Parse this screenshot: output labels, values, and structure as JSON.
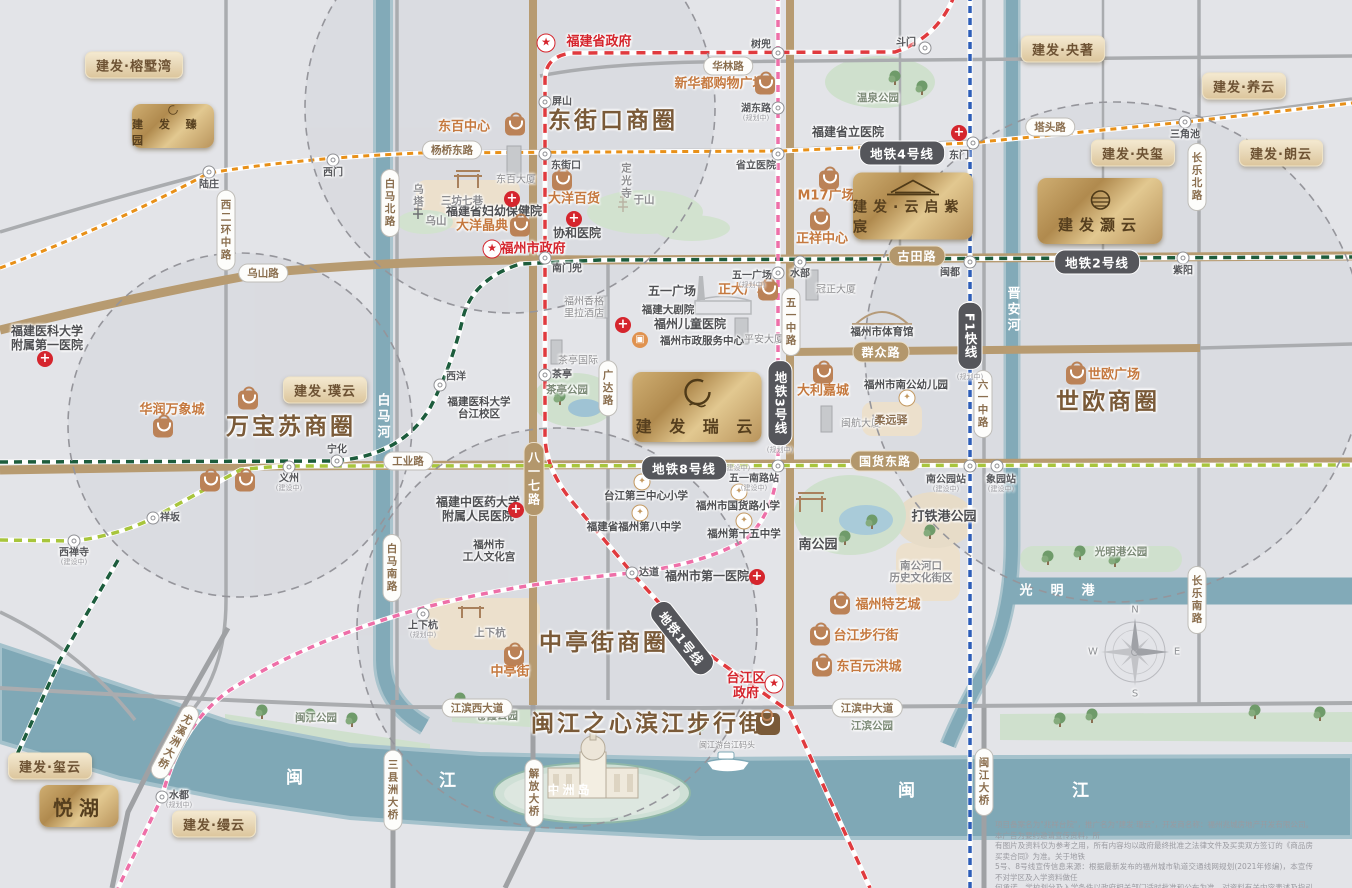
{
  "brand_map_title": "建发瑞云",
  "colors": {
    "gold": "#c2a briefly06e",
    "accent_gold": "#c9a96a",
    "district_brown": "#7a5a38",
    "metro_line1": "#e03a3e",
    "metro_line2": "#1c5c3c",
    "metro_line3": "#ee6fa8",
    "metro_line4": "#e89018",
    "metro_line8": "#a8c53c",
    "metro_f1": "#2e5eb8",
    "road_major": "#b79b71",
    "river": "#7fa8b6",
    "shop_orange": "#c5793f",
    "red": "#d5252d"
  },
  "districts": [
    {
      "name": "东街口商圈",
      "x": 613,
      "y": 121
    },
    {
      "name": "万宝苏商圈",
      "x": 291,
      "y": 427
    },
    {
      "name": "世欧商圈",
      "x": 1108,
      "y": 402
    },
    {
      "name": "中亭街商圈",
      "x": 604,
      "y": 643
    },
    {
      "name": "闽江之心滨江步行街",
      "x": 648,
      "y": 724,
      "bagX": 768,
      "bagY": 724
    }
  ],
  "metro": {
    "lines": [
      {
        "id": "ml1",
        "name": "地铁1号线",
        "color": "#e03a3e"
      },
      {
        "id": "ml2",
        "name": "地铁2号线",
        "color": "#1c5c3c"
      },
      {
        "id": "ml2b",
        "name": "地铁2号线",
        "color": "#1c5c3c"
      },
      {
        "id": "ml3",
        "name": "地铁3号线",
        "color": "#ee6fa8"
      },
      {
        "id": "ml4",
        "name": "地铁4号线",
        "color": "#e89018"
      },
      {
        "id": "ml8",
        "name": "地铁8号线",
        "color": "#a8c53c"
      },
      {
        "id": "mlf1",
        "name": "F1快线",
        "color": "#2e5eb8"
      }
    ],
    "badges": [
      {
        "text": "地铁4号线",
        "x": 902,
        "y": 153,
        "orient": "h"
      },
      {
        "text": "地铁2号线",
        "x": 1097,
        "y": 262,
        "orient": "h"
      },
      {
        "text": "地铁8号线",
        "x": 684,
        "y": 468,
        "orient": "h",
        "tag": "(建设中)",
        "tx": 737,
        "ty": 468
      },
      {
        "text": "地铁3号线",
        "x": 780,
        "y": 403,
        "orient": "v",
        "tag": "(规划中)",
        "tx": 780,
        "ty": 450
      },
      {
        "text": "F1快线",
        "x": 970,
        "y": 336,
        "orient": "v",
        "tag": "(规划中)",
        "tx": 970,
        "ty": 377
      },
      {
        "text": "地铁1号线",
        "x": 682,
        "y": 638,
        "orient": "h",
        "rotate": 52
      }
    ],
    "stations": [
      {
        "n": "陆庄",
        "x": 209,
        "y": 172,
        "lx": 209,
        "ly": 185
      },
      {
        "n": "西门",
        "x": 333,
        "y": 160,
        "lx": 333,
        "ly": 173
      },
      {
        "n": "东街口",
        "x": 545,
        "y": 154,
        "lx": 566,
        "ly": 166
      },
      {
        "n": "省立医院",
        "x": 778,
        "y": 154,
        "lx": 756,
        "ly": 166
      },
      {
        "n": "东门",
        "x": 973,
        "y": 143,
        "lx": 959,
        "ly": 156
      },
      {
        "n": "三角池",
        "x": 1185,
        "y": 122,
        "lx": 1185,
        "ly": 135
      },
      {
        "n": "斗门",
        "x": 925,
        "y": 48,
        "lx": 906,
        "ly": 43
      },
      {
        "n": "树兜",
        "x": 778,
        "y": 53,
        "lx": 761,
        "ly": 45
      },
      {
        "n": "屏山",
        "x": 545,
        "y": 102,
        "lx": 562,
        "ly": 102
      },
      {
        "n": "湖东路",
        "x": 778,
        "y": 108,
        "lx": 756,
        "ly": 109,
        "tag": "(规划中)",
        "tx": 756,
        "ty": 118
      },
      {
        "n": "南门兜",
        "x": 545,
        "y": 258,
        "lx": 567,
        "ly": 269
      },
      {
        "n": "水部",
        "x": 800,
        "y": 262,
        "lx": 800,
        "ly": 274
      },
      {
        "n": "闽都",
        "x": 970,
        "y": 262,
        "lx": 950,
        "ly": 273
      },
      {
        "n": "紫阳",
        "x": 1183,
        "y": 258,
        "lx": 1183,
        "ly": 271
      },
      {
        "n": "五一广场",
        "x": 778,
        "y": 273,
        "lx": 752,
        "ly": 276,
        "tag": "(规划中)",
        "tx": 752,
        "ty": 285
      },
      {
        "n": "茶亭",
        "x": 545,
        "y": 375,
        "lx": 562,
        "ly": 375
      },
      {
        "n": "西洋",
        "x": 440,
        "y": 385,
        "lx": 456,
        "ly": 377
      },
      {
        "n": "宁化",
        "x": 337,
        "y": 461,
        "lx": 337,
        "ly": 450
      },
      {
        "n": "义州",
        "x": 289,
        "y": 467,
        "lx": 289,
        "ly": 479,
        "tag": "(建设中)",
        "tx": 289,
        "ty": 488
      },
      {
        "n": "祥坂",
        "x": 153,
        "y": 518,
        "lx": 170,
        "ly": 518
      },
      {
        "n": "西禅寺",
        "x": 74,
        "y": 541,
        "lx": 74,
        "ly": 553,
        "tag": "(建设中)",
        "tx": 74,
        "ty": 562
      },
      {
        "n": "达道",
        "x": 632,
        "y": 573,
        "lx": 649,
        "ly": 573
      },
      {
        "n": "五一南路站",
        "x": 778,
        "y": 466,
        "lx": 754,
        "ly": 479,
        "tag": "(建设中)",
        "tx": 754,
        "ty": 488
      },
      {
        "n": "南公园站",
        "x": 970,
        "y": 466,
        "lx": 946,
        "ly": 480,
        "tag": "(建设中)",
        "tx": 946,
        "ty": 489
      },
      {
        "n": "象园站",
        "x": 997,
        "y": 466,
        "lx": 1001,
        "ly": 480,
        "tag": "(建设中)",
        "tx": 1001,
        "ty": 489
      },
      {
        "n": "水都",
        "x": 162,
        "y": 797,
        "lx": 179,
        "ly": 796,
        "tag": "(规划中)",
        "tx": 179,
        "ty": 805
      },
      {
        "n": "上下杭",
        "x": 423,
        "y": 614,
        "lx": 423,
        "ly": 626,
        "tag": "(规划中)",
        "tx": 423,
        "ty": 635
      }
    ]
  },
  "road_labels": [
    {
      "text": "古田路",
      "x": 917,
      "y": 256,
      "style": "tan",
      "orient": "h"
    },
    {
      "text": "群众路",
      "x": 881,
      "y": 352,
      "style": "tan",
      "orient": "h"
    },
    {
      "text": "国货东路",
      "x": 885,
      "y": 461,
      "style": "tan",
      "orient": "h"
    },
    {
      "text": "八一七路",
      "x": 534,
      "y": 479,
      "style": "tan",
      "orient": "v"
    },
    {
      "text": "华林路",
      "x": 728,
      "y": 66,
      "style": "white",
      "orient": "h"
    },
    {
      "text": "杨桥东路",
      "x": 452,
      "y": 150,
      "style": "white",
      "orient": "h"
    },
    {
      "text": "塔头路",
      "x": 1050,
      "y": 127,
      "style": "white",
      "orient": "h"
    },
    {
      "text": "乌山路",
      "x": 263,
      "y": 273,
      "style": "white",
      "orient": "h"
    },
    {
      "text": "工业路",
      "x": 408,
      "y": 461,
      "style": "white",
      "orient": "h"
    },
    {
      "text": "江滨西大道",
      "x": 477,
      "y": 708,
      "style": "white",
      "orient": "h"
    },
    {
      "text": "江滨中大道",
      "x": 867,
      "y": 708,
      "style": "white",
      "orient": "h"
    },
    {
      "text": "西二环中路",
      "x": 226,
      "y": 230,
      "style": "white",
      "orient": "v"
    },
    {
      "text": "白马北路",
      "x": 390,
      "y": 203,
      "style": "white",
      "orient": "v"
    },
    {
      "text": "白马南路",
      "x": 392,
      "y": 568,
      "style": "white",
      "orient": "v"
    },
    {
      "text": "长乐北路",
      "x": 1197,
      "y": 177,
      "style": "white",
      "orient": "v"
    },
    {
      "text": "长乐南路",
      "x": 1197,
      "y": 600,
      "style": "white",
      "orient": "v"
    },
    {
      "text": "六一中路",
      "x": 983,
      "y": 404,
      "style": "white",
      "orient": "v"
    },
    {
      "text": "广达路",
      "x": 608,
      "y": 388,
      "style": "white",
      "orient": "v"
    },
    {
      "text": "五一中路",
      "x": 791,
      "y": 322,
      "style": "white",
      "orient": "v"
    },
    {
      "text": "解放大桥",
      "x": 534,
      "y": 793,
      "style": "white",
      "orient": "v"
    },
    {
      "text": "三县洲大桥",
      "x": 393,
      "y": 790,
      "style": "white",
      "orient": "v"
    },
    {
      "text": "闽江大桥",
      "x": 984,
      "y": 782,
      "style": "white",
      "orient": "v"
    },
    {
      "text": "尤溪洲大桥",
      "x": 175,
      "y": 742,
      "style": "white",
      "orient": "v",
      "rotate": 28
    }
  ],
  "water_labels": [
    {
      "text": "白马河",
      "x": 381,
      "y": 417,
      "orient": "v",
      "size": 13
    },
    {
      "text": "晋安河",
      "x": 1011,
      "y": 310,
      "orient": "v",
      "size": 13
    },
    {
      "text": "光明港",
      "x": 1066,
      "y": 592,
      "orient": "h",
      "size": 13,
      "spacing": 18
    },
    {
      "text": "闽",
      "x": 296,
      "y": 779,
      "orient": "h",
      "size": 17
    },
    {
      "text": "江",
      "x": 449,
      "y": 782,
      "orient": "h",
      "size": 17
    },
    {
      "text": "闽",
      "x": 908,
      "y": 792,
      "orient": "h",
      "size": 17
    },
    {
      "text": "江",
      "x": 1082,
      "y": 792,
      "orient": "h",
      "size": 17
    },
    {
      "text": "中洲岛",
      "x": 570,
      "y": 791,
      "orient": "h",
      "size": 12
    }
  ],
  "projects": [
    {
      "name": "建发·榕墅湾",
      "x": 134,
      "y": 65,
      "style": "pill"
    },
    {
      "name": "建发·央著",
      "x": 1063,
      "y": 49,
      "style": "pill"
    },
    {
      "name": "建发·养云",
      "x": 1244,
      "y": 86,
      "style": "pill"
    },
    {
      "name": "建发·央玺",
      "x": 1133,
      "y": 153,
      "style": "pill"
    },
    {
      "name": "建发·朗云",
      "x": 1281,
      "y": 153,
      "style": "pill"
    },
    {
      "name": "建发·璞云",
      "x": 325,
      "y": 390,
      "style": "pill"
    },
    {
      "name": "建发·玺云",
      "x": 50,
      "y": 766,
      "style": "pill"
    },
    {
      "name": "建发·缦云",
      "x": 214,
      "y": 824,
      "style": "pill"
    },
    {
      "name": "建 发 臻 园",
      "x": 173,
      "y": 126,
      "w": 82,
      "h": 44,
      "style": "logo",
      "emblem": "ring",
      "fs": 11
    },
    {
      "name": "建发·云启紫宸",
      "x": 913,
      "y": 206,
      "w": 120,
      "h": 67,
      "style": "logo",
      "emblem": "roof",
      "fs": 14
    },
    {
      "name": "建发灏云",
      "x": 1100,
      "y": 211,
      "w": 125,
      "h": 66,
      "style": "logo",
      "emblem": "moon",
      "fs": 15
    },
    {
      "name": "建 发 瑞 云",
      "x": 697,
      "y": 407,
      "w": 129,
      "h": 70,
      "style": "logo",
      "emblem": "enso",
      "fs": 16
    },
    {
      "name": "悦湖",
      "x": 79,
      "y": 806,
      "w": 79,
      "h": 42,
      "style": "logo",
      "emblem": "none",
      "fs": 20
    }
  ],
  "shops": [
    {
      "name": "东百中心",
      "lx": 464,
      "ly": 128,
      "bx": 515,
      "by": 126
    },
    {
      "name": "新华都购物广场",
      "lx": 720,
      "ly": 85,
      "bx": 765,
      "by": 85
    },
    {
      "name": "大洋百货",
      "lx": 574,
      "ly": 200,
      "bx": 562,
      "by": 181
    },
    {
      "name": "大洋晶典",
      "lx": 482,
      "ly": 227,
      "bx": 520,
      "by": 227
    },
    {
      "name": "M17广场",
      "lx": 826,
      "ly": 197,
      "bx": 829,
      "by": 180
    },
    {
      "name": "正祥中心",
      "lx": 822,
      "ly": 240,
      "bx": 820,
      "by": 221
    },
    {
      "name": "正大广场",
      "lx": 744,
      "ly": 291,
      "bx": 768,
      "by": 291
    },
    {
      "name": "华润万象城",
      "lx": 172,
      "ly": 411,
      "bx": 163,
      "by": 428
    },
    {
      "name": "",
      "lx": 0,
      "ly": 0,
      "bx": 248,
      "by": 400
    },
    {
      "name": "",
      "lx": 0,
      "ly": 0,
      "bx": 210,
      "by": 482
    },
    {
      "name": "",
      "lx": 0,
      "ly": 0,
      "bx": 245,
      "by": 482
    },
    {
      "name": "世欧广场",
      "lx": 1114,
      "ly": 376,
      "bx": 1076,
      "by": 375
    },
    {
      "name": "大利嘉城",
      "lx": 823,
      "ly": 392,
      "bx": 823,
      "by": 374
    },
    {
      "name": "福州特艺城",
      "lx": 888,
      "ly": 606,
      "bx": 840,
      "by": 605
    },
    {
      "name": "台江步行街",
      "lx": 866,
      "ly": 637,
      "bx": 820,
      "by": 636
    },
    {
      "name": "东百元洪城",
      "lx": 869,
      "ly": 668,
      "bx": 822,
      "by": 667
    },
    {
      "name": "中亭街",
      "lx": 510,
      "ly": 673,
      "bx": 514,
      "by": 656
    }
  ],
  "hospitals": [
    {
      "lines": [
        "福建省立医院"
      ],
      "lx": 848,
      "ly": 133,
      "cx": 959,
      "cy": 133
    },
    {
      "lines": [
        "协和医院"
      ],
      "lx": 577,
      "ly": 234,
      "cx": 574,
      "cy": 219
    },
    {
      "lines": [
        "福建省妇幼保健院"
      ],
      "lx": 494,
      "ly": 212,
      "cx": 512,
      "cy": 199
    },
    {
      "lines": [
        "福州儿童医院"
      ],
      "lx": 690,
      "ly": 325,
      "cx": 623,
      "cy": 325
    },
    {
      "lines": [
        "福州市第一医院"
      ],
      "lx": 707,
      "ly": 577,
      "cx": 757,
      "cy": 577
    },
    {
      "lines": [
        "福建医科大学",
        "附属第一医院"
      ],
      "lx": 47,
      "ly": 339,
      "cx": 45,
      "cy": 359
    },
    {
      "lines": [
        "福建中医药大学",
        "附属人民医院"
      ],
      "lx": 478,
      "ly": 510,
      "cx": 516,
      "cy": 510
    }
  ],
  "schools": [
    {
      "name": "台江第三中心小学",
      "lx": 646,
      "ly": 496,
      "ix": 642,
      "iy": 482
    },
    {
      "name": "福州市国货路小学",
      "lx": 738,
      "ly": 506,
      "ix": 739,
      "iy": 492
    },
    {
      "name": "福建省福州第八中学",
      "lx": 634,
      "ly": 527,
      "ix": 640,
      "iy": 513
    },
    {
      "name": "福州第十五中学",
      "lx": 744,
      "ly": 534,
      "ix": 744,
      "iy": 521
    },
    {
      "name": "福州市南公幼儿园",
      "lx": 906,
      "ly": 385,
      "ix": 907,
      "iy": 398
    }
  ],
  "government": [
    {
      "lines": [
        "福建省政府"
      ],
      "lx": 599,
      "ly": 43,
      "sx": 546,
      "sy": 43
    },
    {
      "lines": [
        "福州市政府"
      ],
      "lx": 533,
      "ly": 250,
      "sx": 492,
      "sy": 249
    },
    {
      "lines": [
        "台江区",
        "政府"
      ],
      "lx": 746,
      "ly": 687,
      "sx": 774,
      "sy": 684
    }
  ],
  "places": [
    {
      "lines": [
        "福州市政服务中心"
      ],
      "x": 702,
      "y": 341,
      "cls": "dark small",
      "icon": "svc",
      "ix": 640,
      "iy": 340
    },
    {
      "lines": [
        "福建医科大学",
        "台江校区"
      ],
      "x": 479,
      "y": 408,
      "cls": "dark small"
    },
    {
      "lines": [
        "福州市",
        "工人文化宫"
      ],
      "x": 489,
      "y": 551,
      "cls": "dark small"
    },
    {
      "lines": [
        "福州香格",
        "里拉酒店"
      ],
      "x": 584,
      "y": 308,
      "cls": "bldg"
    },
    {
      "lines": [
        "茶亭国际"
      ],
      "x": 578,
      "y": 361,
      "cls": "bldg"
    },
    {
      "lines": [
        "东百大厦"
      ],
      "x": 516,
      "y": 180,
      "cls": "bldg"
    },
    {
      "lines": [
        "平安大厦"
      ],
      "x": 764,
      "y": 340,
      "cls": "bldg"
    },
    {
      "lines": [
        "冠正大厦"
      ],
      "x": 836,
      "y": 290,
      "cls": "bldg"
    },
    {
      "lines": [
        "闽航大厦"
      ],
      "x": 861,
      "y": 424,
      "cls": "bldg"
    },
    {
      "lines": [
        "福建大剧院"
      ],
      "x": 668,
      "y": 310,
      "cls": "dark small"
    },
    {
      "lines": [
        "福州市体育馆"
      ],
      "x": 882,
      "y": 332,
      "cls": "dark small"
    },
    {
      "lines": [
        "五一广场"
      ],
      "x": 672,
      "y": 292,
      "cls": "dark"
    },
    {
      "lines": [
        "柔远驿"
      ],
      "x": 891,
      "y": 421,
      "cls": "brown"
    },
    {
      "lines": [
        "三坊七巷"
      ],
      "x": 462,
      "y": 201,
      "cls": "area"
    },
    {
      "lines": [
        "乌山"
      ],
      "x": 436,
      "y": 221,
      "cls": "area"
    },
    {
      "lines": [
        "乌塔"
      ],
      "x": 418,
      "y": 196,
      "cls": "area",
      "vert": true
    },
    {
      "lines": [
        "于山"
      ],
      "x": 644,
      "y": 200,
      "cls": "area"
    },
    {
      "lines": [
        "定光寺"
      ],
      "x": 626,
      "y": 181,
      "cls": "area",
      "vert": true
    },
    {
      "lines": [
        "温泉公园"
      ],
      "x": 878,
      "y": 98,
      "cls": "park"
    },
    {
      "lines": [
        "茶亭公园"
      ],
      "x": 567,
      "y": 390,
      "cls": "park"
    },
    {
      "lines": [
        "闽江公园"
      ],
      "x": 316,
      "y": 718,
      "cls": "park"
    },
    {
      "lines": [
        "苍霞公园"
      ],
      "x": 497,
      "y": 716,
      "cls": "park"
    },
    {
      "lines": [
        "江滨公园"
      ],
      "x": 872,
      "y": 726,
      "cls": "park"
    },
    {
      "lines": [
        "光明港公园"
      ],
      "x": 1121,
      "y": 552,
      "cls": "park"
    },
    {
      "lines": [
        "南公园"
      ],
      "x": 818,
      "y": 546,
      "cls": "parkbig"
    },
    {
      "lines": [
        "打铁港公园"
      ],
      "x": 944,
      "y": 518,
      "cls": "parkbig"
    },
    {
      "lines": [
        "南公河口",
        "历史文化街区"
      ],
      "x": 921,
      "y": 572,
      "cls": "area"
    },
    {
      "lines": [
        "上下杭"
      ],
      "x": 490,
      "y": 633,
      "cls": "area"
    },
    {
      "lines": [
        "闽江游台江码头"
      ],
      "x": 727,
      "y": 745,
      "cls": "tiny"
    }
  ],
  "compass": {
    "n": "N",
    "e": "E",
    "s": "S",
    "w": "W",
    "x": 1135,
    "y": 652
  },
  "disclaimer": [
    "项目备案名为\"兆祥台院\"，推广名为\"建发·瑞云\"，开发商名称：福州兆城房地产开发有限公司。本广告为要约邀请宣传资料，所",
    "有图片及资料仅为参考之用，所有内容均以政府最终批准之法律文件及买卖双方签订的《商品房买卖合同》为准。关于地铁",
    "5号、8号线宣传信息来源：根据最新发布的福州城市轨道交通线网规划(2021年修编)，本宣传不对学区及入学资料做任",
    "何承诺，学校划分及入学条件以政府相关部门适时批准和公布为准，对资料有关内容表述及指引信息，本公司有权进行修改",
    "更新及最终解释权，并以最新资料为准。敬请自行关注！本宣传资料制作时间为2024年1月，有效期至2024年12月31日。"
  ]
}
